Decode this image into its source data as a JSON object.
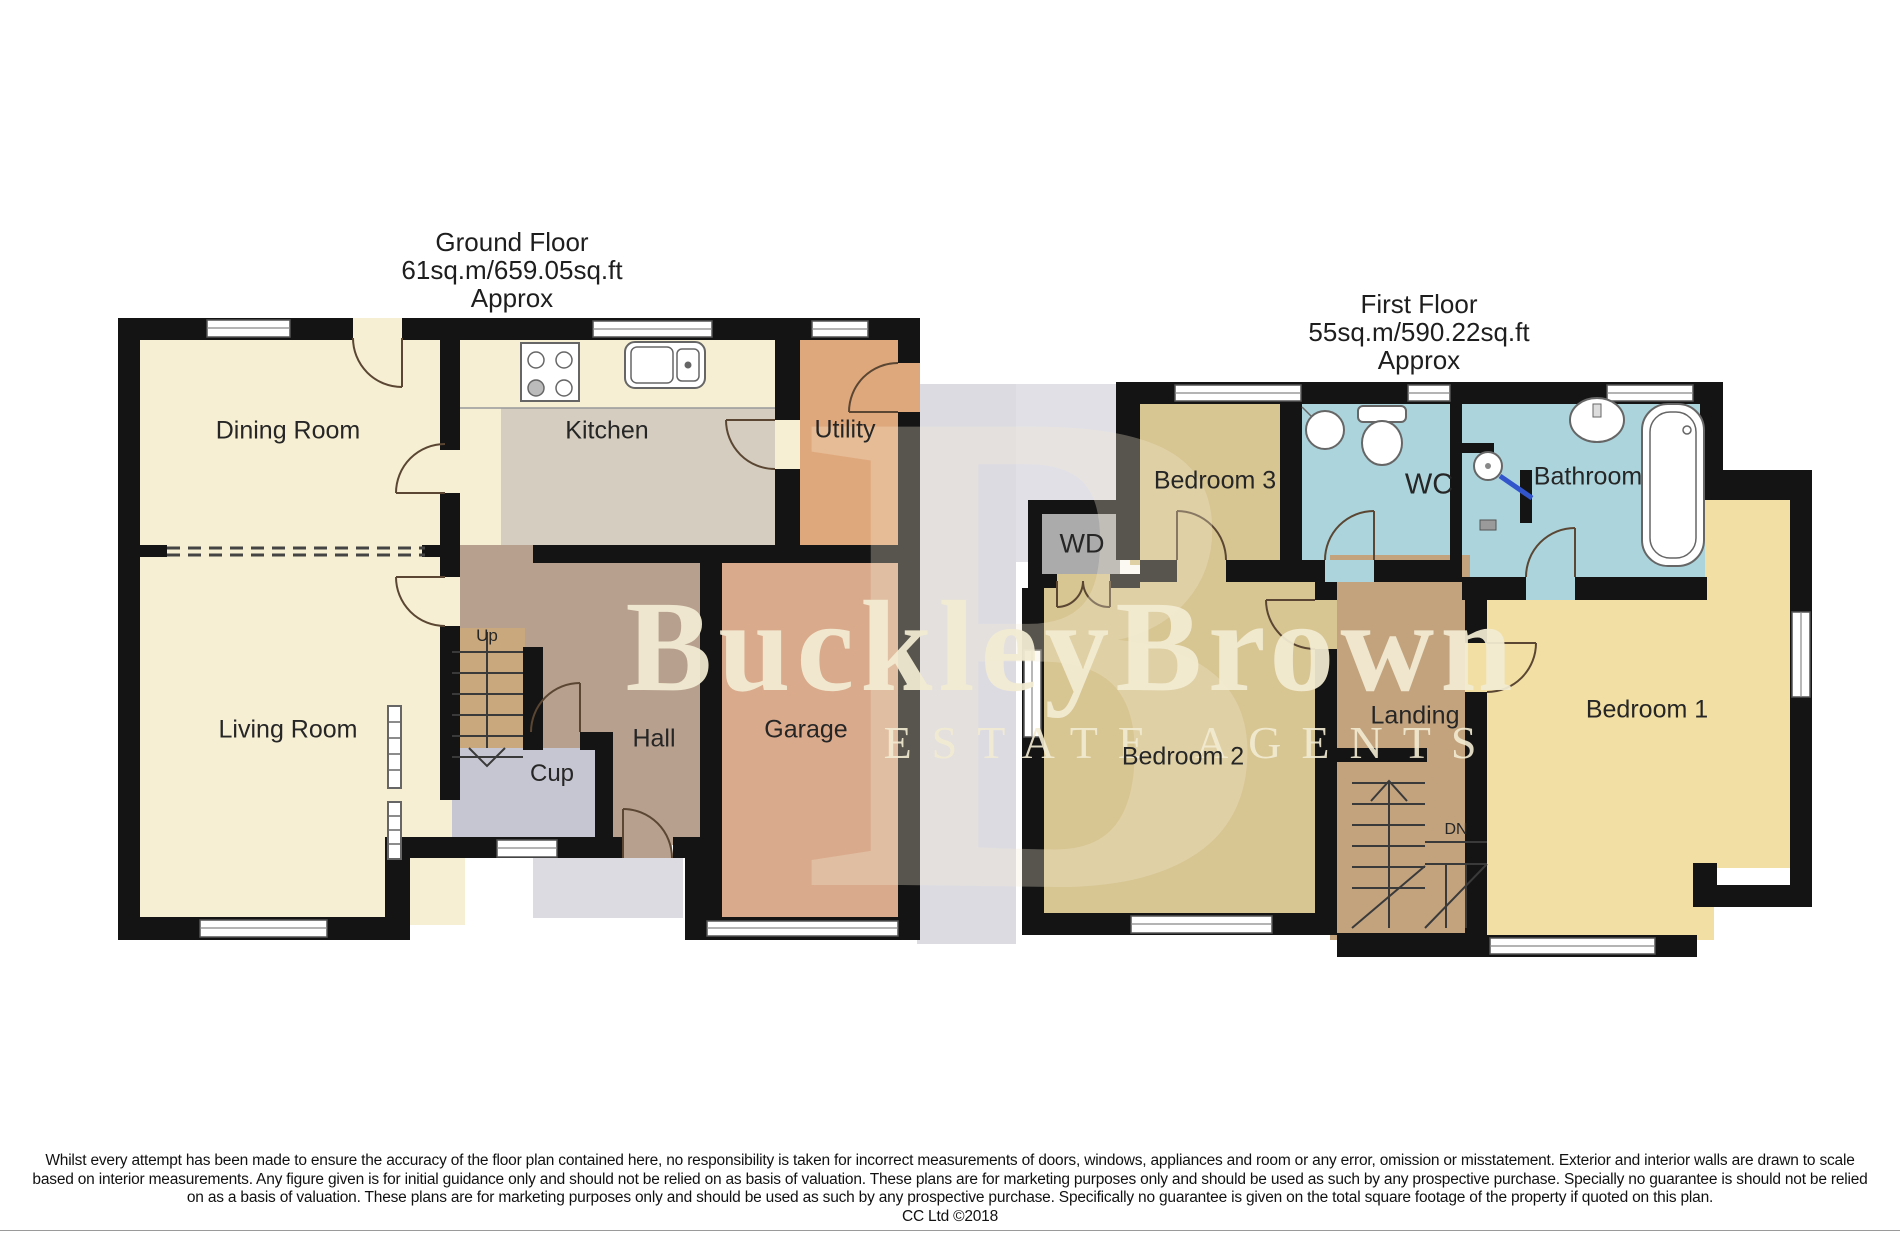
{
  "ground_floor": {
    "title_line1": "Ground Floor",
    "title_line2": "61sq.m/659.05sq.ft",
    "title_line3": "Approx",
    "rooms": {
      "dining": "Dining Room",
      "kitchen": "Kitchen",
      "utility": "Utility",
      "living": "Living Room",
      "hall": "Hall",
      "cup": "Cup",
      "garage": "Garage",
      "stairs_up": "Up"
    }
  },
  "first_floor": {
    "title_line1": "First Floor",
    "title_line2": "55sq.m/590.22sq.ft",
    "title_line3": "Approx",
    "rooms": {
      "bedroom3": "Bedroom 3",
      "wd": "WD",
      "wc": "WC",
      "bathroom": "Bathroom",
      "bedroom2": "Bedroom 2",
      "landing": "Landing",
      "bedroom1": "Bedroom 1",
      "stairs_dn": "DN"
    }
  },
  "watermark": {
    "brand": "BuckleyBrown",
    "tagline": "ESTATE AGENTS",
    "monogram": "B"
  },
  "footer": {
    "line1": "Whilst every attempt has been made to ensure the accuracy of the floor plan contained here, no responsibility is taken for incorrect measurements of doors, windows, appliances and room or any error, omission or misstatement. Exterior and interior walls are drawn to scale",
    "line2": "based on interior measurements. Any figure given is for initial guidance only and should not be relied on as basis of valuation. These plans are for marketing purposes only and should be used as such by any prospective purchase. Specially no guarantee is should not be relied",
    "line3": "on as a basis of valuation. These plans are for marketing purposes only and should be used as such by any prospective purchase. Specifically no guarantee is given on the total square footage of the property if quoted on this plan.",
    "line4": "CC Ltd ©2018"
  },
  "colors": {
    "wall": "#141414",
    "cream": "#f6efd3",
    "kitchen_floor": "#d4cdc0",
    "utility": "#dfa87c",
    "hall": "#b7a08e",
    "garage": "#d9aa8c",
    "cup": "#c6c6d2",
    "stairs": "#c9a87e",
    "bedroom": "#d7c592",
    "bedroom1": "#f2dfa4",
    "bath": "#abd4dc",
    "landing": "#c2a37e",
    "wd": "#ababab",
    "gray_band": "#dcdbe2",
    "watermark": "#f3ecd3",
    "door_arc": "#5a4632",
    "text": "#222222"
  }
}
